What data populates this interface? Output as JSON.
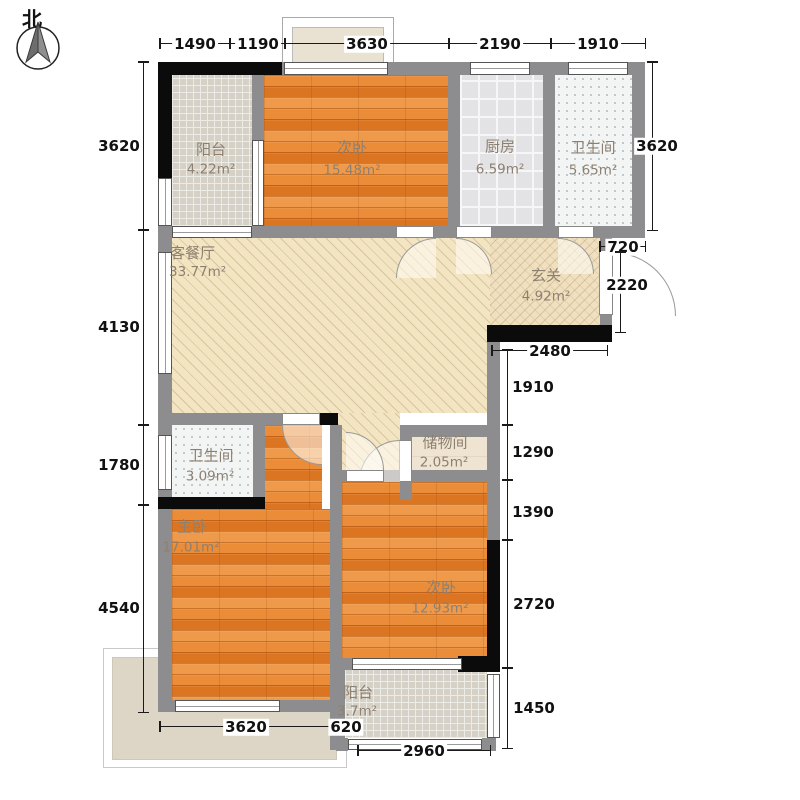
{
  "compass": {
    "label": "北"
  },
  "rooms": {
    "balcony_top": {
      "name": "阳台",
      "area": "4.22m²"
    },
    "bedroom_top": {
      "name": "次卧",
      "area": "15.48m²"
    },
    "kitchen": {
      "name": "厨房",
      "area": "6.59m²"
    },
    "bath_top": {
      "name": "卫生间",
      "area": "5.65m²"
    },
    "living": {
      "name": "客餐厅",
      "area": "33.77m²"
    },
    "entry": {
      "name": "玄关",
      "area": "4.92m²"
    },
    "storage": {
      "name": "储物间",
      "area": "2.05m²"
    },
    "bath_mid": {
      "name": "卫生间",
      "area": "3.09m²"
    },
    "master": {
      "name": "主卧",
      "area": "17.01m²"
    },
    "bedroom_bottom": {
      "name": "次卧",
      "area": "12.93m²"
    },
    "balcony_bottom": {
      "name": "阳台",
      "area": "3.7m²"
    }
  },
  "dims": {
    "top": [
      "1490",
      "1190",
      "3630",
      "2190",
      "1910"
    ],
    "left": [
      "3620",
      "4130",
      "1780",
      "4540"
    ],
    "right": [
      "3620",
      "720",
      "2220",
      "2480",
      "1910",
      "1290",
      "1390",
      "2720",
      "1450"
    ],
    "bottom": [
      "3620",
      "620",
      "2960"
    ]
  },
  "colors": {
    "wood_floor": "#e6822e",
    "living_hatch": "#f3e5c2",
    "wall_gray": "#8d8d8f",
    "wall_black": "#0b0b0b",
    "balcony_tile": "#d6d1c7",
    "bath_tile": "#f3f5f4",
    "label_text": "#8d8071",
    "dim_text": "#111111"
  }
}
